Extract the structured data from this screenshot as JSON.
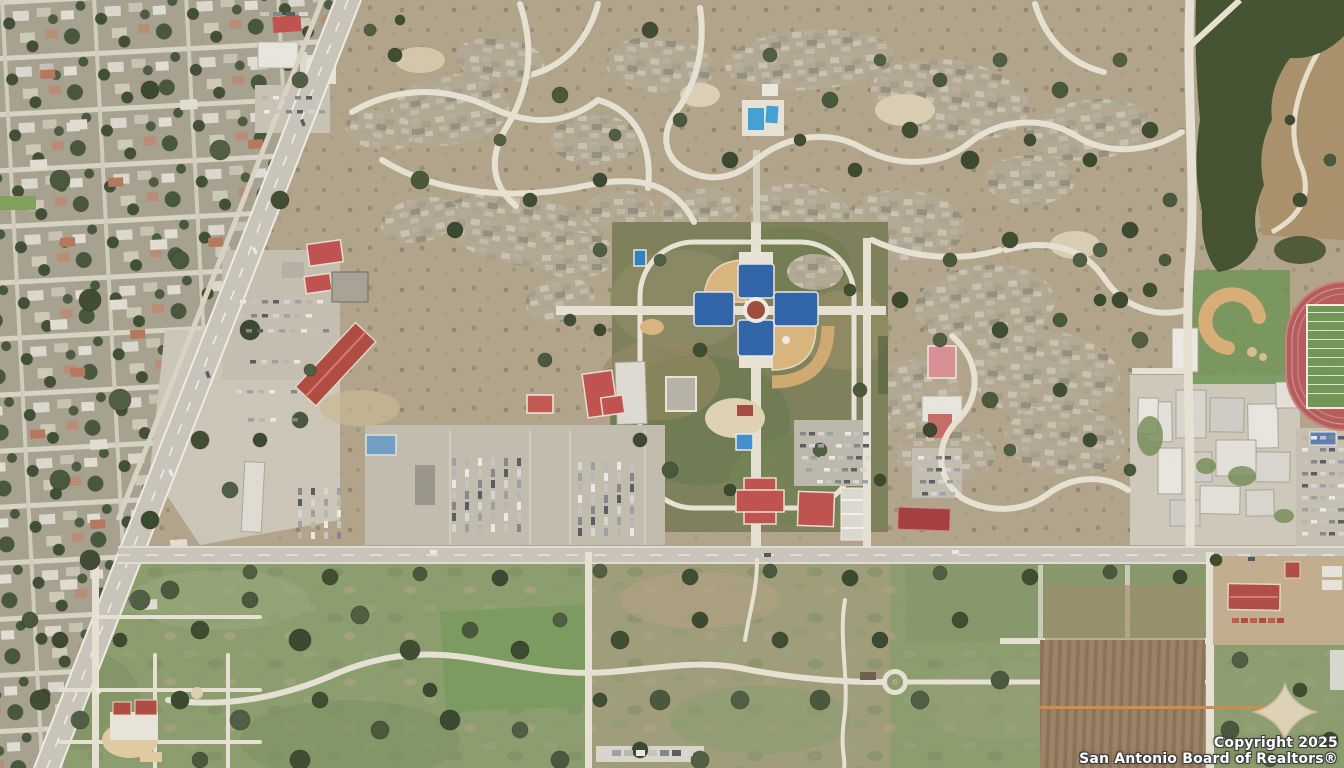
{
  "image": {
    "type": "aerial-satellite-photo",
    "description": "Top-down satellite photo of a San Antonio suburban area: dense residential grid and a divided highway on the west, scrubland with winding trails across the north, a cross-shaped community ballfield complex in the center, red-roofed civic buildings and equipment yards along an east-west road, a school campus with running track and ball field on the east, dark woods and a brown farm field in the northeast corner, and green parkland with trails, tilled orchard rows and a pale four-pointed star plaza to the south."
  },
  "watermark": {
    "line1": "Copyright 2025",
    "line2": "San Antonio Board of Realtors®"
  },
  "palette": {
    "terrain": "#b2a48a",
    "residential": "#a5a18e",
    "road-light": "#e7e2d4",
    "highway": "#c9c5ba",
    "park-green": "#7d7f5a",
    "south-green": "#8a9c6c",
    "tree-green": "#3e4c31",
    "diamond-tan": "#d9b57c",
    "track-red": "#b65a5a",
    "field-green": "#6f9455",
    "roof-red": "#c0504d",
    "pool-blue": "#3fa0d4",
    "bleacher-blue": "#2d63a8",
    "woods": "#41502f",
    "farm-brown": "#a8906a",
    "orchard-brown": "#94795b",
    "concrete": "#c9c3b5",
    "white-bldg": "#e8e6df"
  },
  "landmarks": [
    "residential-grid",
    "divided-highway",
    "scrubland-trails",
    "ballfield-complex",
    "community-buildings",
    "equipment-yards",
    "school-campus",
    "running-track",
    "baseball-field",
    "woods",
    "farm-field",
    "main-road",
    "south-parkland",
    "orchard-rows",
    "star-plaza",
    "church-with-red-roof",
    "swimming-pools",
    "copyright-watermark"
  ]
}
